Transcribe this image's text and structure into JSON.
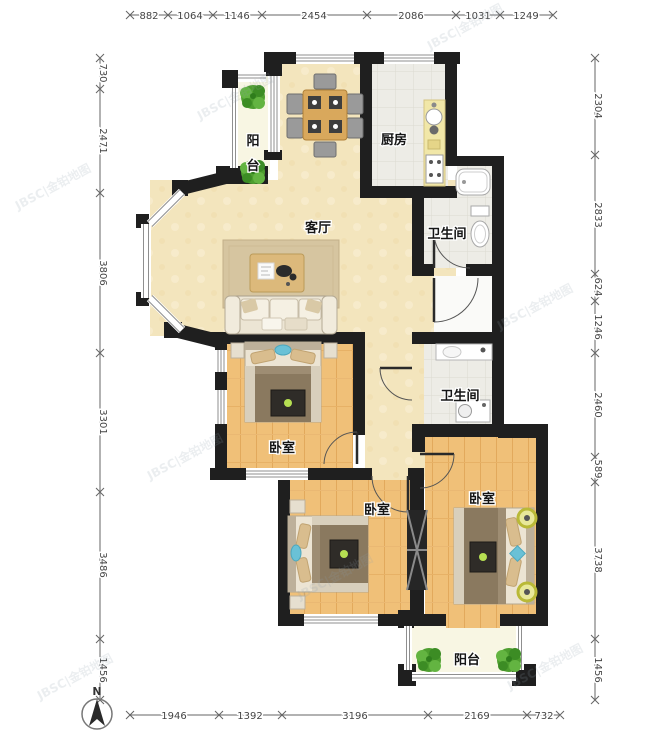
{
  "plan": {
    "type": "apartment-floor-plan",
    "units": "mm"
  },
  "rooms": {
    "living": {
      "label": "客厅"
    },
    "kitchen": {
      "label": "厨房"
    },
    "bath_upper": {
      "label": "卫生间"
    },
    "bath_lower": {
      "label": "卫生间"
    },
    "bedroom_master": {
      "label": "卧室"
    },
    "bedroom_mid": {
      "label": "卧室"
    },
    "bedroom_right": {
      "label": "卧室"
    },
    "balcony_top": {
      "label": "阳台",
      "chars": [
        "阳",
        "台"
      ]
    },
    "balcony_bottom": {
      "label": "阳台"
    }
  },
  "dimensions_mm": {
    "top": [
      882,
      1064,
      1146,
      2454,
      2086,
      1031,
      1249
    ],
    "left": [
      730,
      2471,
      3806,
      3301,
      3486,
      1456
    ],
    "right": [
      2304,
      2833,
      624,
      1246,
      2460,
      589,
      3738,
      1456
    ],
    "bottom": [
      1946,
      1392,
      3196,
      2169,
      732
    ]
  },
  "compass": {
    "north_label": "N"
  },
  "watermark": {
    "text": "JBSC|金铂地图"
  },
  "colors": {
    "wall": "#1f1f1f",
    "living_floor": "#f3e5bd",
    "wood_floor": "#f0c078",
    "tile_floor": "#edece6",
    "balcony_floor": "#f8f6e3",
    "blanket": "#8a795f",
    "accent_blue": "#6ac1d6",
    "plant_green": "#4e9e2f",
    "counter_yellow": "#f1e7a8"
  }
}
